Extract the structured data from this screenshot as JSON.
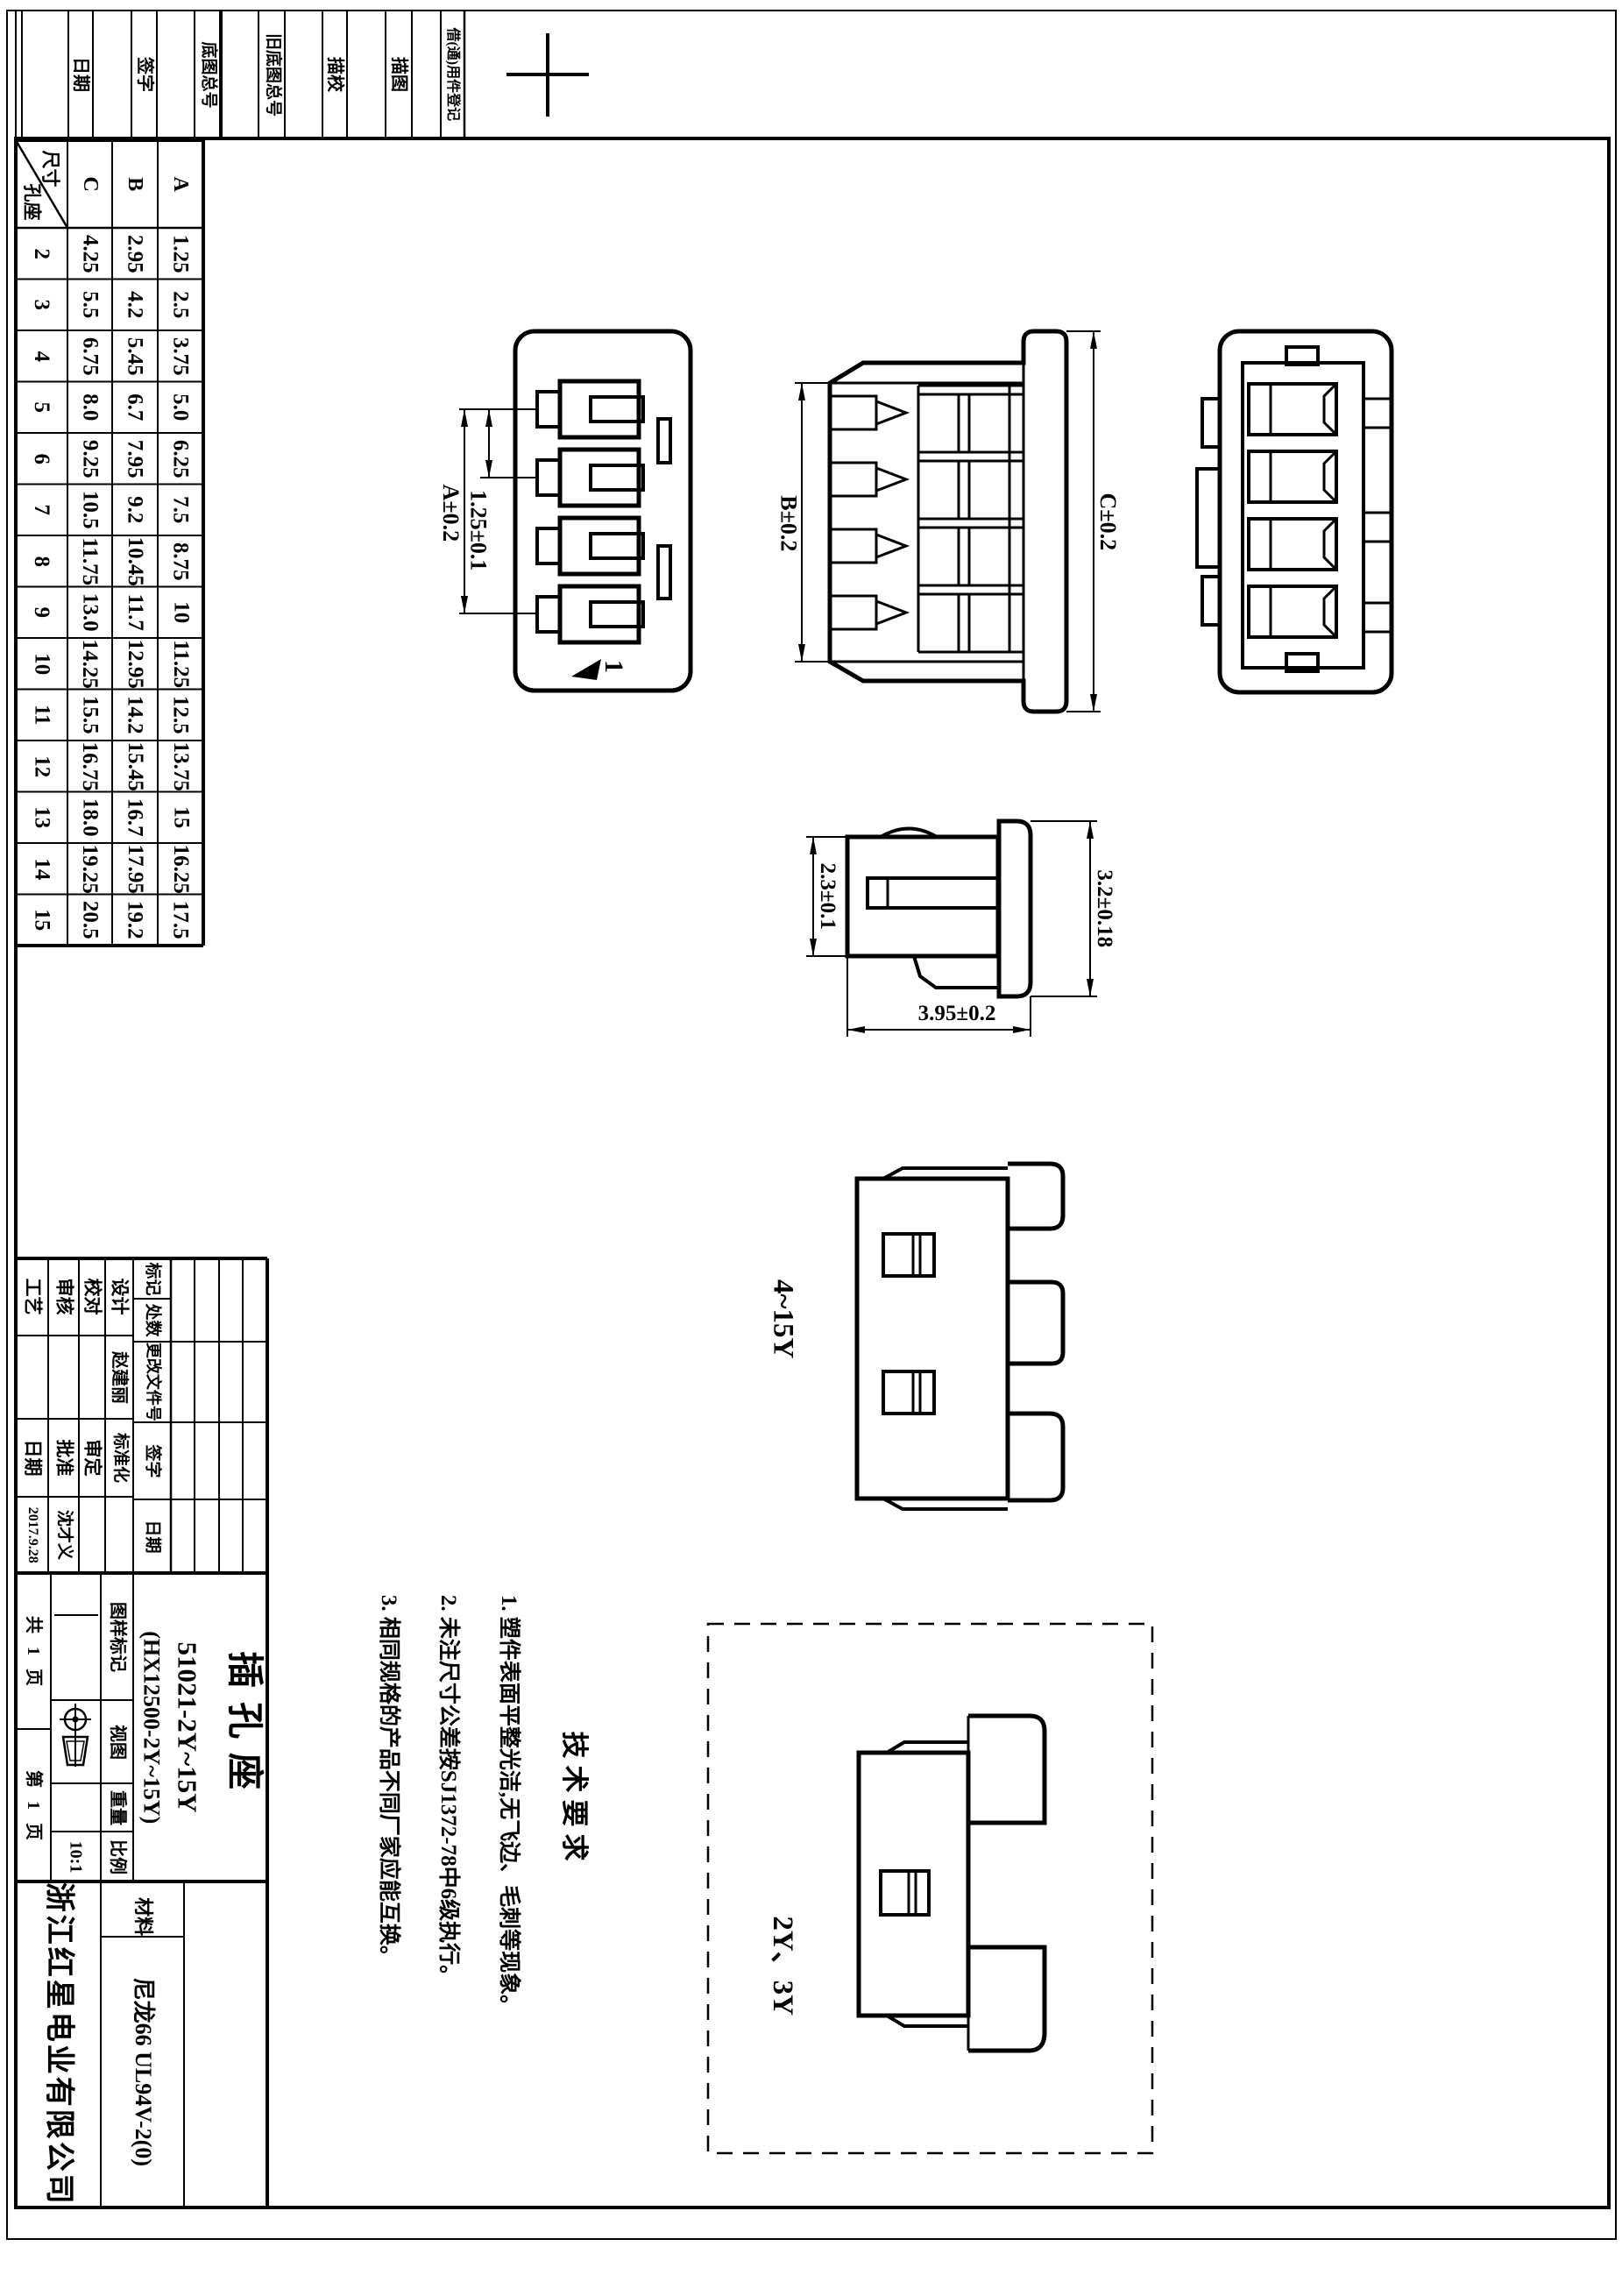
{
  "sheet": {
    "background": "#ffffff",
    "line_color": "#000000"
  },
  "margin_strip": {
    "labels": [
      "日期",
      "签字",
      "底图总号",
      "旧底图总号",
      "描校",
      "描图",
      "借(通)用件登记"
    ]
  },
  "dim_table": {
    "corner_top": "尺寸",
    "corner_bottom": "孔座",
    "columns": [
      "C",
      "B",
      "A"
    ],
    "rows": [
      {
        "n": "2",
        "c": "4.25",
        "b": "2.95",
        "a": "1.25"
      },
      {
        "n": "3",
        "c": "5.5",
        "b": "4.2",
        "a": "2.5"
      },
      {
        "n": "4",
        "c": "6.75",
        "b": "5.45",
        "a": "3.75"
      },
      {
        "n": "5",
        "c": "8.0",
        "b": "6.7",
        "a": "5.0"
      },
      {
        "n": "6",
        "c": "9.25",
        "b": "7.95",
        "a": "6.25"
      },
      {
        "n": "7",
        "c": "10.5",
        "b": "9.2",
        "a": "7.5"
      },
      {
        "n": "8",
        "c": "11.75",
        "b": "10.45",
        "a": "8.75"
      },
      {
        "n": "9",
        "c": "13.0",
        "b": "11.7",
        "a": "10"
      },
      {
        "n": "10",
        "c": "14.25",
        "b": "12.95",
        "a": "11.25"
      },
      {
        "n": "11",
        "c": "15.5",
        "b": "14.2",
        "a": "12.5"
      },
      {
        "n": "12",
        "c": "16.75",
        "b": "15.45",
        "a": "13.75"
      },
      {
        "n": "13",
        "c": "18.0",
        "b": "16.7",
        "a": "15"
      },
      {
        "n": "14",
        "c": "19.25",
        "b": "17.95",
        "a": "16.25"
      },
      {
        "n": "15",
        "c": "20.5",
        "b": "19.2",
        "a": "17.5"
      }
    ]
  },
  "drawing": {
    "dim_a": "A±0.2",
    "dim_pitch": "1.25±0.1",
    "dim_b": "B±0.2",
    "dim_c": "C±0.2",
    "dim_depth": "2.3±0.1",
    "dim_height": "3.2±0.18",
    "dim_width": "3.95±0.2",
    "pin_marker": "1",
    "variant_range": "4~15Y",
    "variant_small": "2Y、3Y"
  },
  "tech_requirements": {
    "title": "技术要求",
    "items": [
      "1. 塑件表面平整光洁,无飞边、毛刺等现象。",
      "2. 未注尺寸公差按SJ1372-78中6级执行。",
      "3. 相同规格的产品不同厂家应能互换。"
    ]
  },
  "title_block": {
    "part_name": "插孔座",
    "part_number": "51021-2Y~15Y",
    "part_number_alt": "(HX12500-2Y~15Y)",
    "company": "浙江红星电业有限公司",
    "material_label": "材料",
    "material": "尼龙66 UL94V-2(0)",
    "labels": {
      "design": "设计",
      "check": "校对",
      "review": "审核",
      "process": "工艺",
      "standardization": "标准化",
      "review_approve": "审定",
      "approve": "批准",
      "date": "日期",
      "mark": "标记",
      "count": "处数",
      "change_doc": "更改文件号",
      "signature": "签字",
      "drawing_mark": "图样标记",
      "view": "视图",
      "weight": "重量",
      "scale": "比例"
    },
    "values": {
      "designer": "赵建丽",
      "approver": "沈才义",
      "date": "2017.9.28",
      "scale": "10:1",
      "sheet_total": "共 1 页",
      "sheet_page": "第 1 页"
    }
  }
}
